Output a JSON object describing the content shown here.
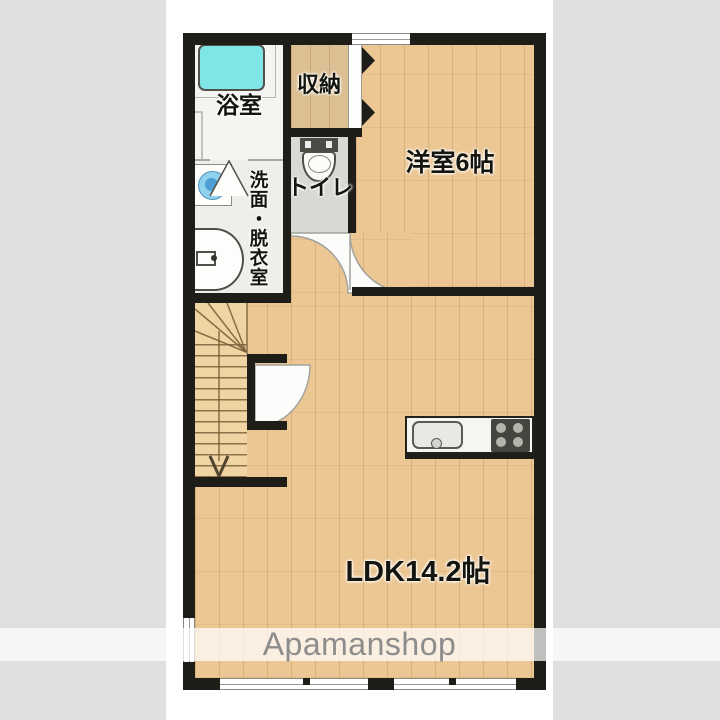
{
  "watermark": {
    "brand": "Apamanshop"
  },
  "rooms": {
    "bathroom": {
      "label": "浴室"
    },
    "closet": {
      "label": "収納"
    },
    "western_room": {
      "label": "洋室6帖"
    },
    "toilet": {
      "label": "トイレ"
    },
    "washroom": {
      "label": "洗面・脱衣室"
    },
    "ldk": {
      "label": "LDK14.2帖"
    }
  },
  "fixtures": [
    "bathtub-icon",
    "washing-machine-icon",
    "vanity-sink-icon",
    "toilet-icon",
    "folding-door-icon",
    "closet-door-icon",
    "door-swing-arc",
    "staircase-icon",
    "kitchen-sink-icon",
    "stove-icon",
    "window-icon"
  ],
  "colors": {
    "background": "#dfdfdf",
    "panel": "#ffffff",
    "wall": "#1e1d18",
    "wood_floor": "#ecc794",
    "closet_floor": "#dcc094",
    "bath_floor": "#f4f4f1",
    "toilet_floor": "#d8d8d4",
    "bathtub": "#7fe6e7",
    "washer_blue": "#8ed2ee",
    "watermark_text": "#8d8d8d"
  }
}
